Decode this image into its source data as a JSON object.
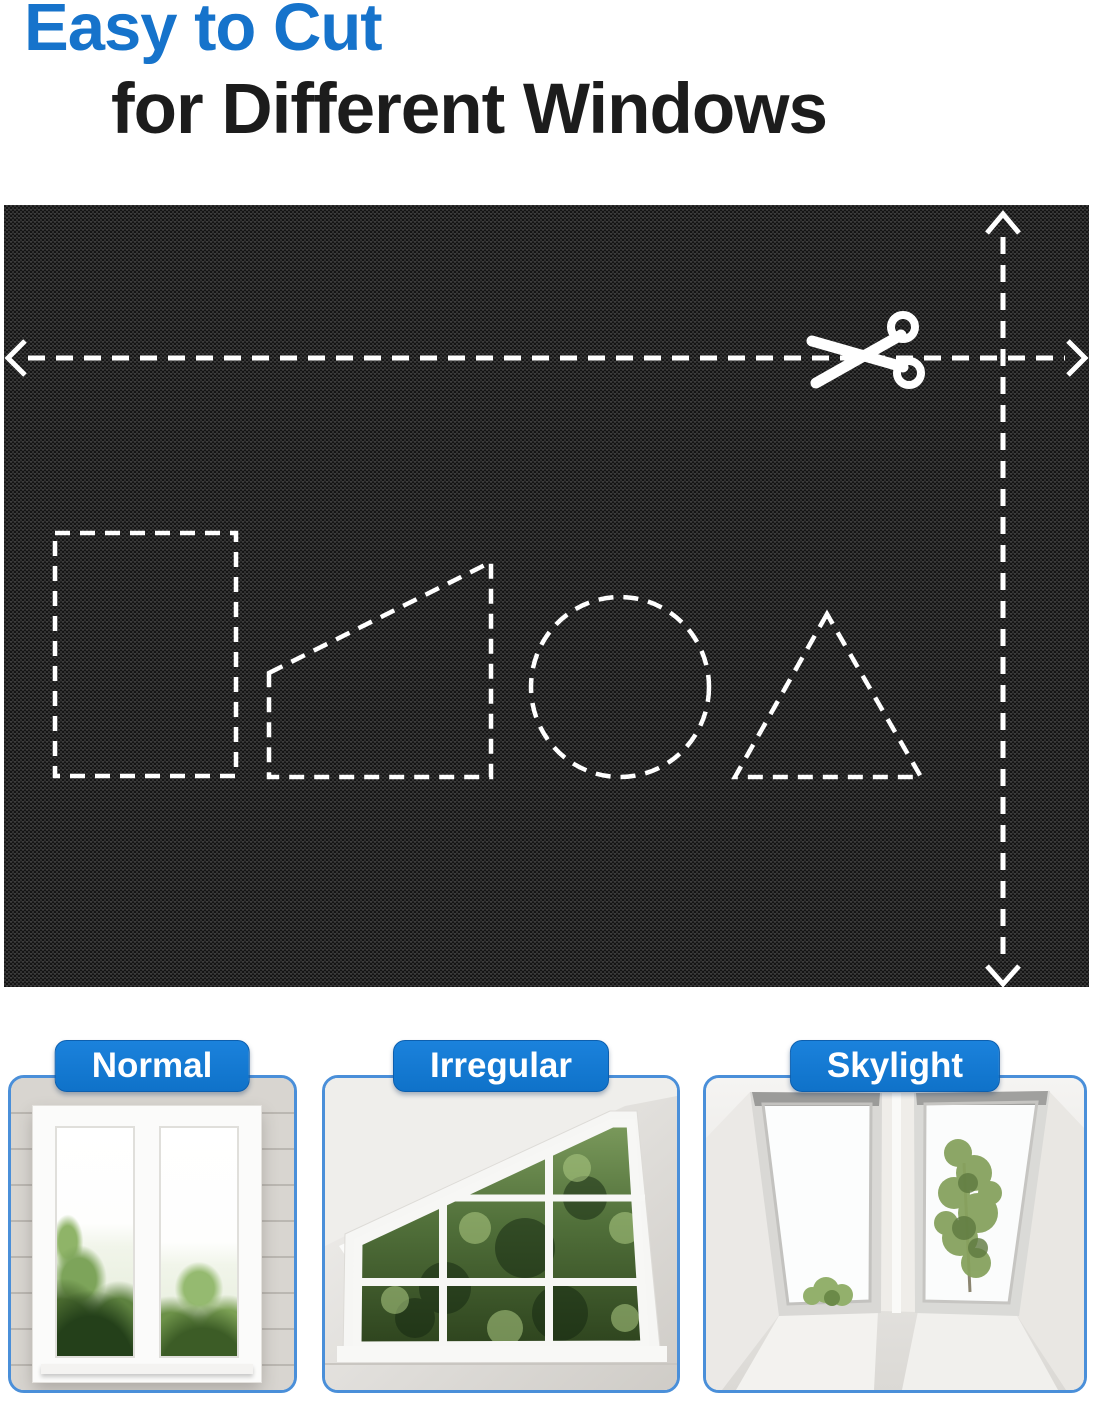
{
  "title": {
    "line1": "Easy to Cut",
    "line2": "for Different Windows"
  },
  "palette": {
    "title_blue": "#1673cb",
    "title_black": "#1c1c1c",
    "label_blue": "#1076d2",
    "panel_border_blue": "#4a8fd9",
    "fabric_black": "#1e1e1e",
    "cut_line_white": "#ffffff"
  },
  "fabric_diagram": {
    "icon": "scissors-icon",
    "arrows": [
      {
        "name": "horizontal-cut-arrow"
      },
      {
        "name": "vertical-cut-arrow"
      }
    ],
    "cutout_shapes": [
      {
        "name": "rectangle"
      },
      {
        "name": "trapezoid"
      },
      {
        "name": "circle"
      },
      {
        "name": "triangle"
      }
    ]
  },
  "window_types": [
    {
      "label": "Normal"
    },
    {
      "label": "Irregular"
    },
    {
      "label": "Skylight"
    }
  ]
}
